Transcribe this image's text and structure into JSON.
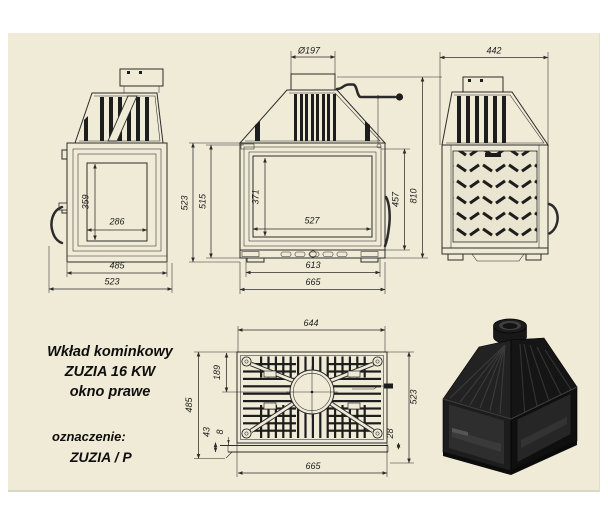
{
  "info": {
    "product_line1": "Wkład kominkowy",
    "product_line2": "ZUZIA 16 KW",
    "product_line3": "okno prawe",
    "designation_label": "oznaczenie:",
    "designation_value": "ZUZIA / P"
  },
  "dims": {
    "side": {
      "glass_h": "359",
      "glass_w": "286",
      "base_inner": "485",
      "base_outer": "523"
    },
    "front": {
      "flue": "Ø197",
      "h_outer": "523",
      "h_inner": "515",
      "glass_h": "371",
      "glass_w": "527",
      "door_h": "457",
      "total_h": "810",
      "w_inner": "613",
      "w_outer": "665"
    },
    "rear": {
      "width": "442"
    },
    "top": {
      "w_inner": "644",
      "flue_pos": "189",
      "depth_inner": "485",
      "front_lip": "43",
      "gap": "8",
      "rear_lip": "28",
      "depth_outer": "523",
      "w_outer": "665"
    }
  },
  "colors": {
    "panel_bg": "#f0ebd7",
    "line": "#2b2b2b",
    "render_black": "#161616"
  }
}
